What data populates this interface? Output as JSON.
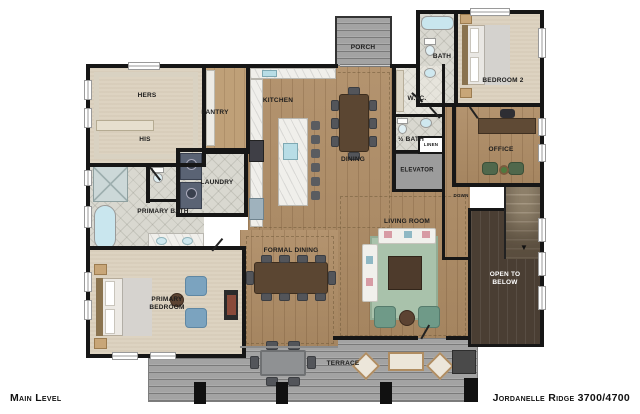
{
  "footer": {
    "left": "Main Level",
    "right": "Jordanelle Ridge 3700/4700"
  },
  "labels": {
    "porch": "PORCH",
    "bath": "BATH",
    "bedroom2": "BEDROOM 2",
    "hers": "HERS",
    "his": "HIS",
    "pantry": "PANTRY",
    "kitchen": "KITCHEN",
    "dining": "DINING",
    "wic": "W.I.C.",
    "half_bath": "½ BATH",
    "linen": "LINEN",
    "elevator": "ELEVATOR",
    "office": "OFFICE",
    "laundry": "LAUNDRY",
    "primary_bath": "PRIMARY BATH",
    "primary_bedroom": "PRIMARY BEDROOM",
    "formal_dining": "FORMAL DINING",
    "living_room": "LIVING ROOM",
    "down": "DOWN",
    "open_to_below": "OPEN TO BELOW",
    "terrace": "TERRACE"
  },
  "colors": {
    "wall": "#161616",
    "wood_floor": "#af8d66",
    "carpet": "#ddd3c1",
    "bath_tile": "#d9d8d0",
    "deck_gray": "#a3a3a3",
    "dark_wood": "#4a3e33",
    "rug_green": "#a9c2ab",
    "accent_blue_chair": "#7ba3bf",
    "accent_green_chair": "#6f9a88",
    "marble": "#f0efeb"
  }
}
